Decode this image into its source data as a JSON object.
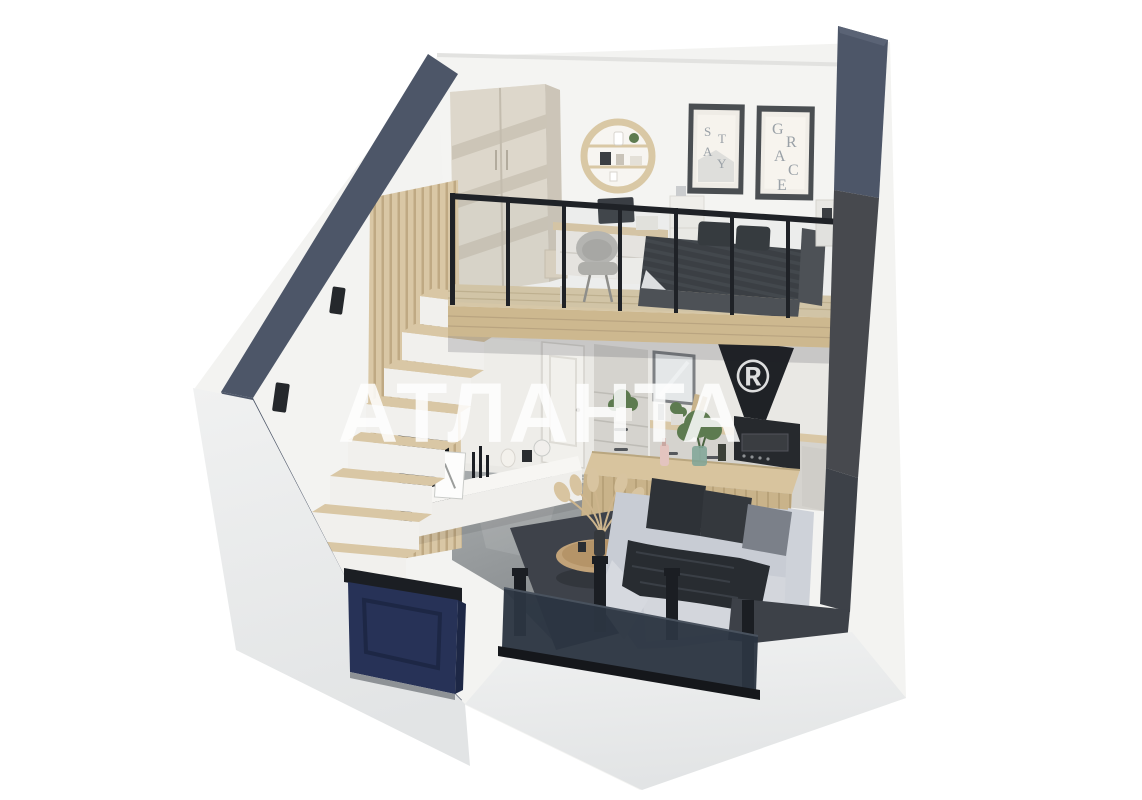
{
  "watermark": {
    "text": "АТЛАНТА",
    "registered": "®"
  },
  "posters": [
    {
      "name": "poster-stay",
      "letters": [
        "S",
        "T",
        "A",
        "Y"
      ]
    },
    {
      "name": "poster-grace",
      "letters": [
        "G",
        "R",
        "A",
        "C",
        "E"
      ]
    }
  ],
  "palette": {
    "interior": "#f3f3f1",
    "outerFace": "#eaeced",
    "wallBlue": "#4d5668",
    "wallGray": "#47494e",
    "wallWrap": "#3d4148",
    "navy": "#273257",
    "navyDark": "#1d2745",
    "frameBlack": "#1b1e23",
    "railBlack": "#1f2227",
    "woodLight": "#d9c7a5",
    "woodMid": "#cdb88f",
    "concrete": "#9ba0a2",
    "sofa": "#c8ccd4",
    "sofaLight": "#d3d6dc",
    "pillowDark": "#2e3237",
    "pillowGray": "#7b8089",
    "throwBlanket": "#282c31",
    "rug": "#3e424a",
    "bedBase": "#474a50",
    "wardrobe": "#ddd7cb",
    "wardrobeStripe": "#ccc5b7",
    "cabinet": "#d5d3ce",
    "cabinetLight": "#e9e8e4",
    "hood": "#1f2226",
    "plantGreen": "#5d7b50",
    "white": "#f7f6f3",
    "posterFrame": "#4a4e52",
    "posterText": "#9aa1a7",
    "watermark": "#ffffff"
  },
  "scene": {
    "description": "3D cutaway render of a two-level loft studio apartment",
    "objects": [
      "left-wall",
      "right-wall",
      "back-wall",
      "loft-floor",
      "loft-railing",
      "wardrobe",
      "round-wall-shelf",
      "desk",
      "desk-chair",
      "bed",
      "posters",
      "kitchen-cabinets",
      "range-hood",
      "kitchen-island",
      "sofa",
      "coffee-table",
      "rug",
      "tv",
      "tv-console",
      "slat-partition",
      "staircase",
      "entrance-door",
      "french-balcony",
      "wall-sconces",
      "concrete-floor"
    ]
  }
}
